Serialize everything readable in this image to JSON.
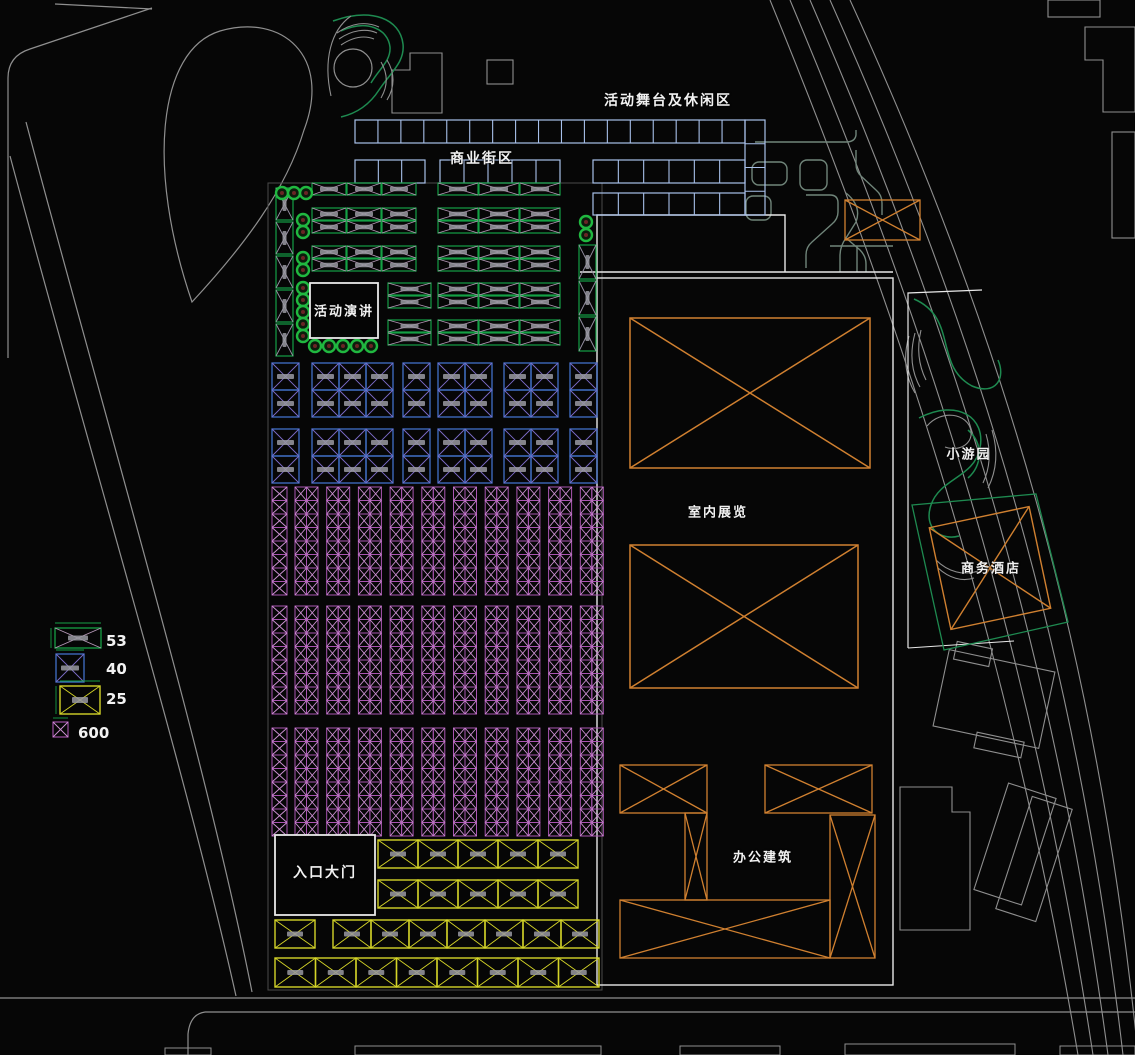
{
  "labels": {
    "stage_area": "活动舞台及休闲区",
    "commercial_street": "商业街区",
    "event_speech": "活动演讲",
    "indoor_exhibition": "室内展览",
    "small_garden": "小游园",
    "business_hotel": "商务酒店",
    "office_building": "办公建筑",
    "entrance_gate": "入口大门"
  },
  "legend": {
    "items": [
      {
        "name": "large-green-booth",
        "count": "53",
        "color": "#15a045"
      },
      {
        "name": "square-blue-booth",
        "count": "40",
        "color": "#4070c8"
      },
      {
        "name": "wide-yellow-booth",
        "count": "25",
        "color": "#d4d428"
      },
      {
        "name": "small-purple-booth",
        "count": "600",
        "color": "#aa55b2"
      }
    ]
  },
  "colors": {
    "background": "#060606",
    "road_grey": "#8f8f8f",
    "outline_white": "#e8e8e8",
    "parcel_grey": "#4a4a4a",
    "commercial_blue": "#a8c0ea",
    "booth_green": "#15a045",
    "booth_green_x": "#b497b5",
    "booth_blue": "#4070c8",
    "booth_blue_x": "#7d6cc9",
    "booth_purple": "#aa55b2",
    "booth_purple_x": "#d093d6",
    "booth_yellow": "#d4d428",
    "building_orange": "#d08030",
    "tree_ring_green": "#20b840",
    "tree_center": "#6a2525",
    "path_green_grey": "#70857a",
    "garden_green": "#1e8a50",
    "booth_text_grey": "#9a9aa2",
    "label_white": "#f2f2f2"
  }
}
